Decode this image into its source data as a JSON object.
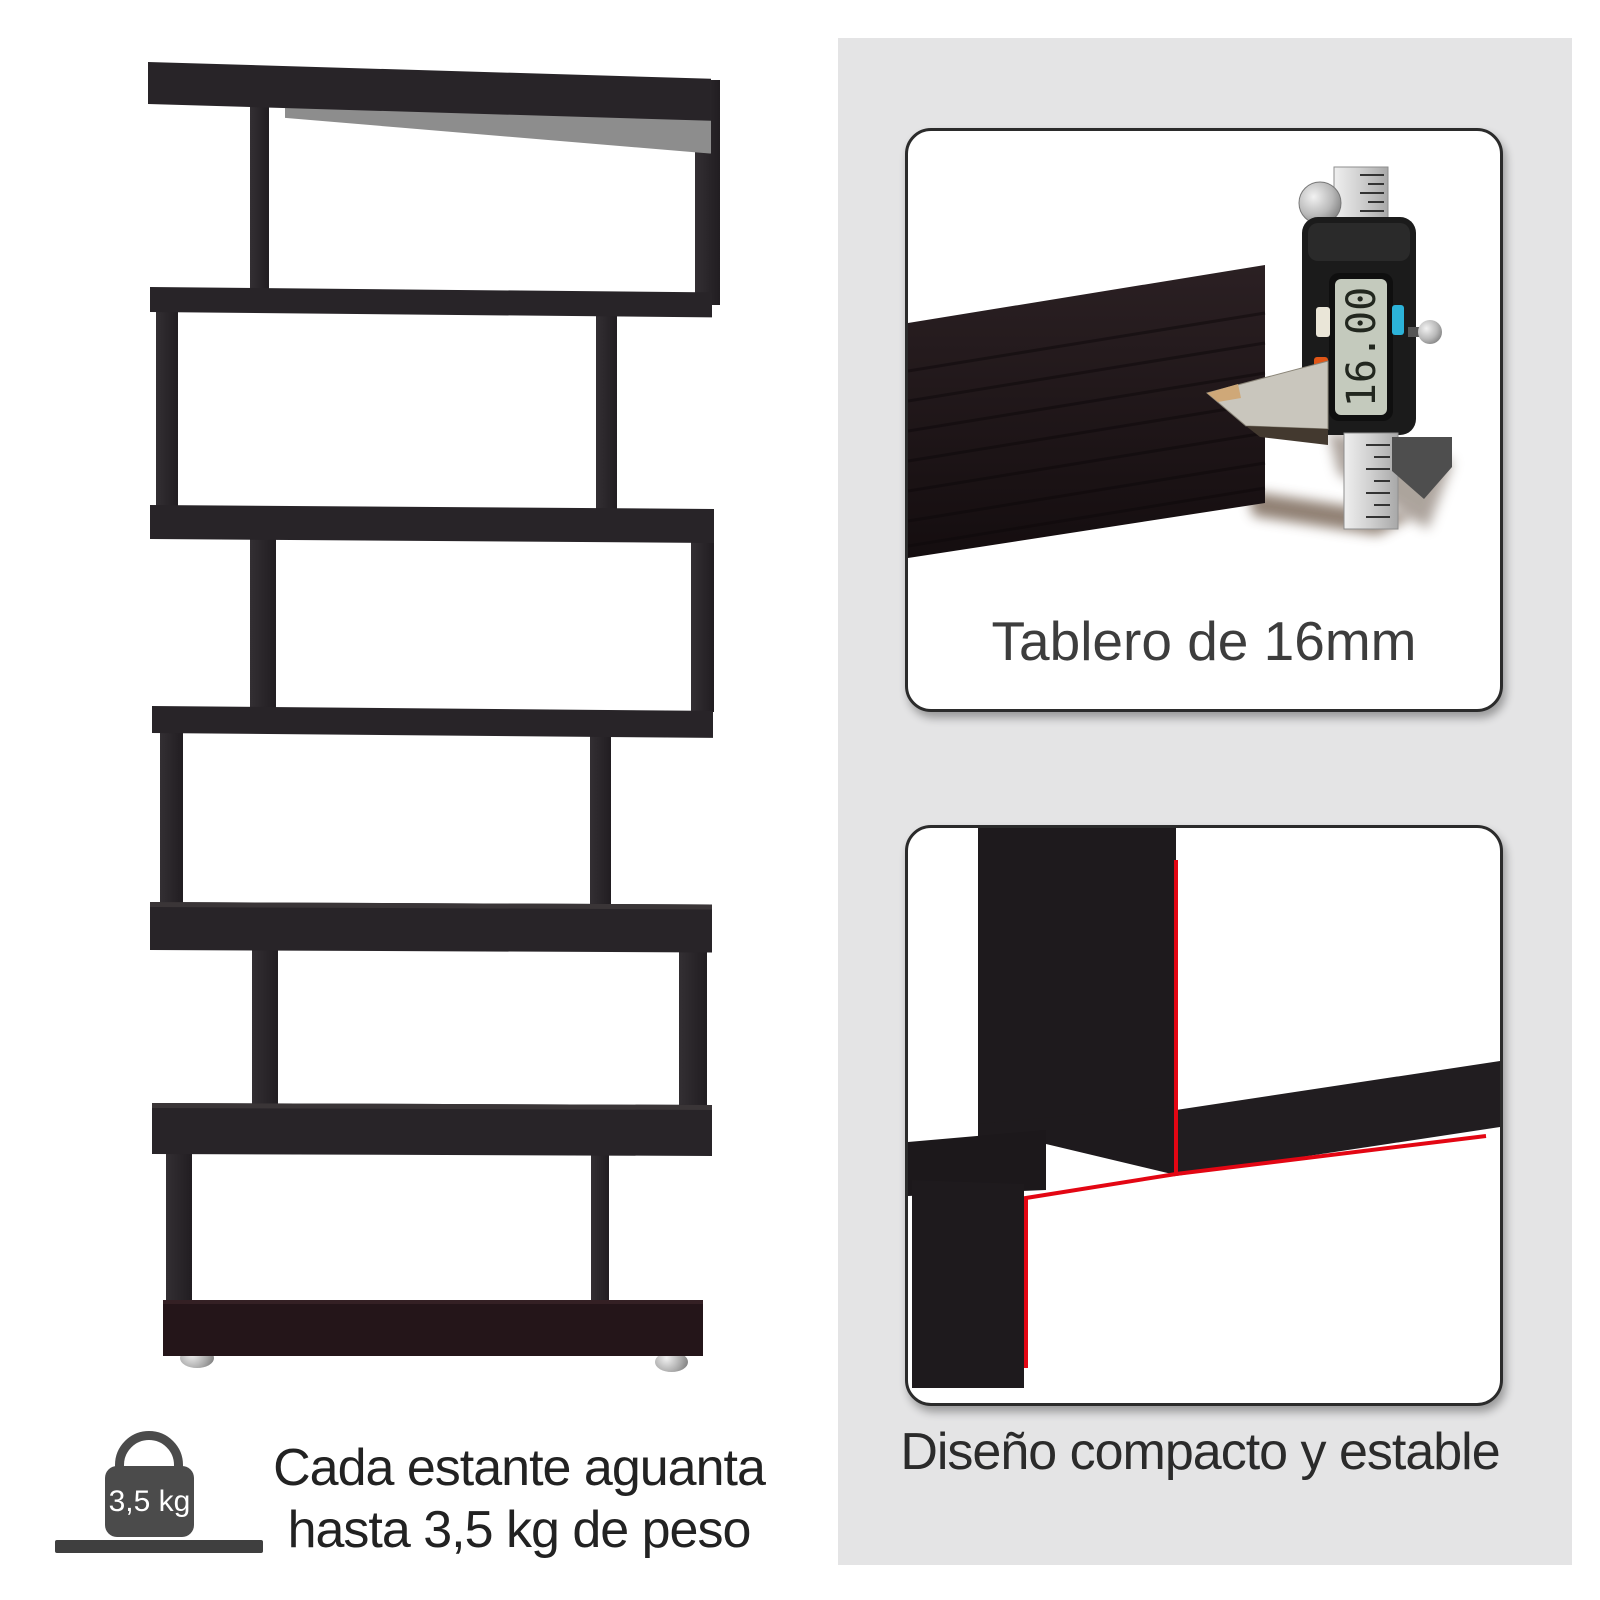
{
  "colors": {
    "panel_gray": "#e4e4e5",
    "card_border": "#2b2b2b",
    "accent_red": "#e30613",
    "shelf_dark": "#282428",
    "shelf_base": "#241519",
    "icon_gray": "#4b4b4b"
  },
  "top_card": {
    "caption": "Tablero de 16mm",
    "caliper_reading": "16.00"
  },
  "bottom_card": {
    "caption": "Diseño compacto y estable"
  },
  "capacity_note": {
    "icon_label": "3,5 kg",
    "line1": "Cada estante aguanta",
    "line2": "hasta 3,5 kg de peso"
  }
}
